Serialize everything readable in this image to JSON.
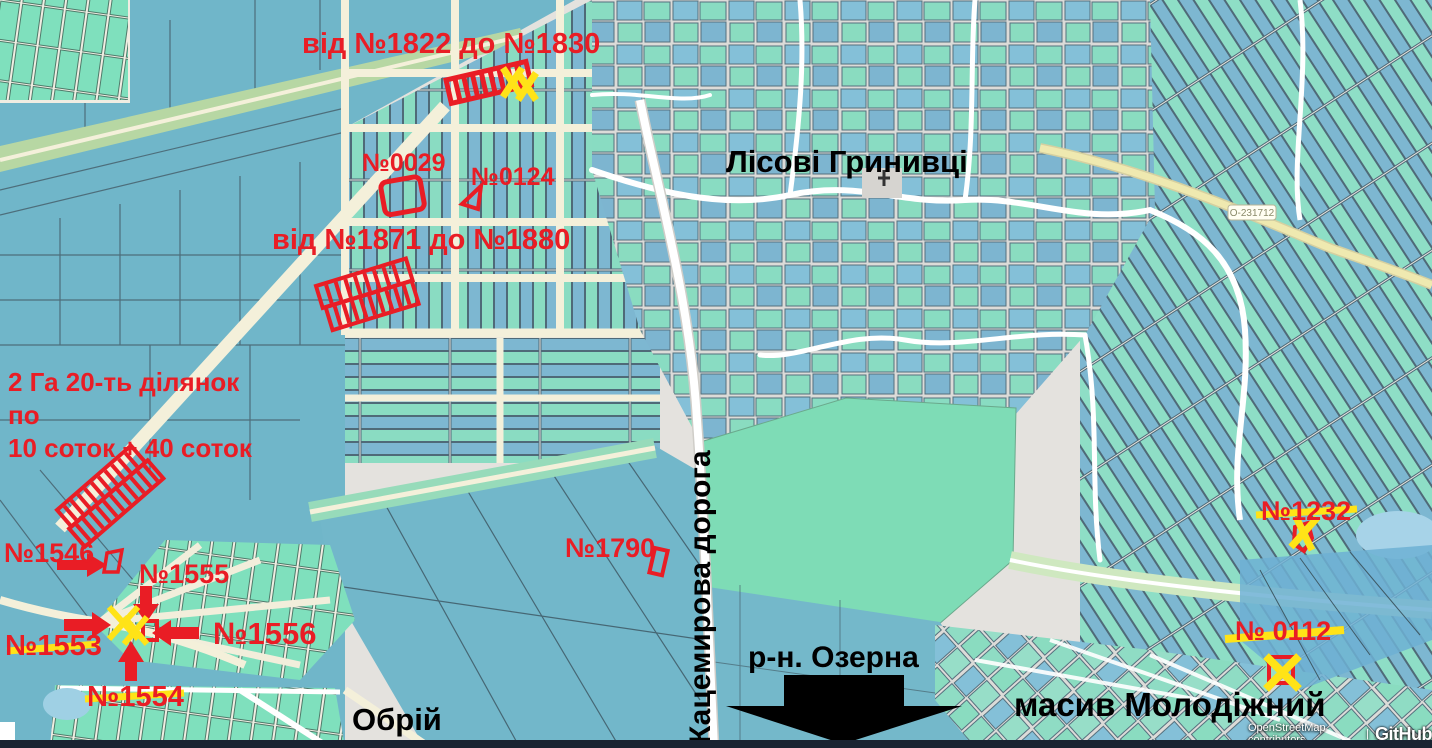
{
  "map": {
    "labels": {
      "village": "Лісові Гринивці",
      "road_vertical": "Кацемирова дорога",
      "district": "р-н. Озерна",
      "massif": "масив Молодіжний",
      "neighborhood": "Обрій"
    },
    "annotations": {
      "range_1822_1830": "від №1822 до №1830",
      "plot_0029": "№0029",
      "plot_0124": "№0124",
      "range_1871_1880": "від №1871 до №1880",
      "area_note_line1": "2 Га 20-ть ділянок по",
      "area_note_line2": "10 соток + 40 соток",
      "plot_1546": "№1546",
      "plot_1555": "№1555",
      "plot_1553": "№1553",
      "plot_1556": "№1556",
      "plot_1554": "№1554",
      "plot_1790": "№1790",
      "plot_1232": "№1232",
      "plot_0112": "№ 0112"
    },
    "road_badge": "О-231712",
    "attribution": {
      "osm": "OpenStreetMap contributors",
      "separator": "|",
      "brand": "GitHub"
    },
    "colors": {
      "annotation_red": "#E91D25",
      "annotation_yellow": "#FFE317",
      "label_black": "#000000",
      "parcel_blue": "#7DB7D1",
      "parcel_green": "#8ADCC2",
      "field_teal": "#70B6C9",
      "field_green": "#7EDCB6",
      "road_cream": "#F4F0DA",
      "road_yellow": "#EFE9B0",
      "water_blue": "#A7D3E8",
      "map_gray": "#E4E2DE"
    }
  }
}
